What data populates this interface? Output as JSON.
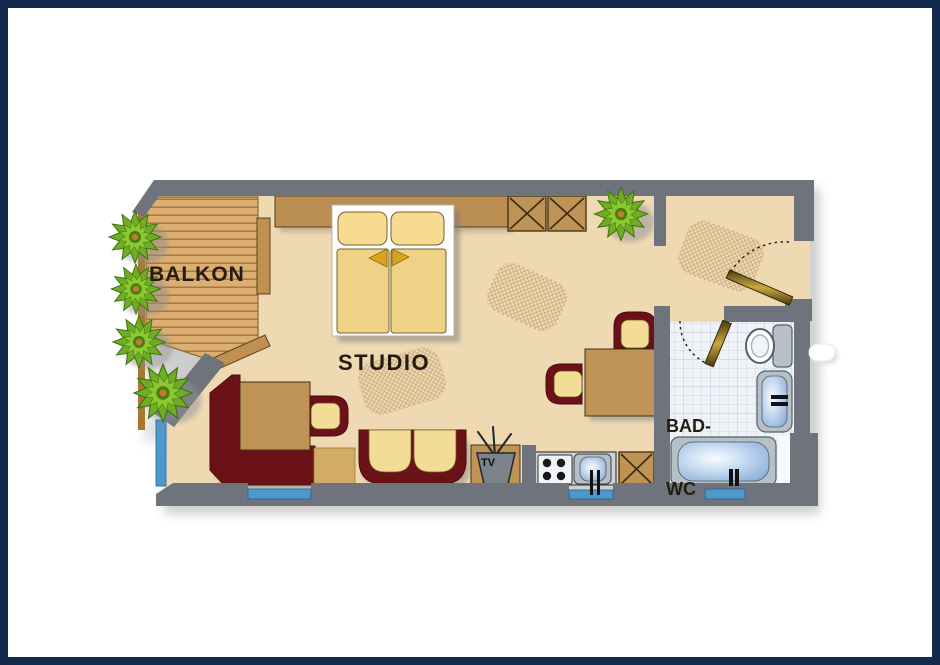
{
  "page": {
    "type": "apartment floor plan",
    "frame_color": "#13294e",
    "background": "#ffffff"
  },
  "floorplan": {
    "rooms": [
      {
        "id": "balcony",
        "label": "BALKON"
      },
      {
        "id": "studio",
        "label": "STUDIO"
      },
      {
        "id": "bathroom",
        "label_line1": "BAD-",
        "label_line2": "WC"
      }
    ],
    "tv_label": "TV",
    "colors": {
      "wall": "#6f747c",
      "floor": "#eed9b3",
      "deck_plank": "#dcae71",
      "deck_gap": "#a5783c",
      "furniture_wood": "#bf9255",
      "upholstery_maroon": "#6b1118",
      "cushion_cream": "#f3dc96",
      "bed_linen": "#f0d287",
      "accent_gold": "#d9a41d",
      "window_glass": "#4f98cc",
      "bathroom_tile": "#eff3f7",
      "fixture_gray": "#b7bfc7",
      "water_blue": "#82a8d6",
      "plant_green": "#6fae24"
    }
  }
}
